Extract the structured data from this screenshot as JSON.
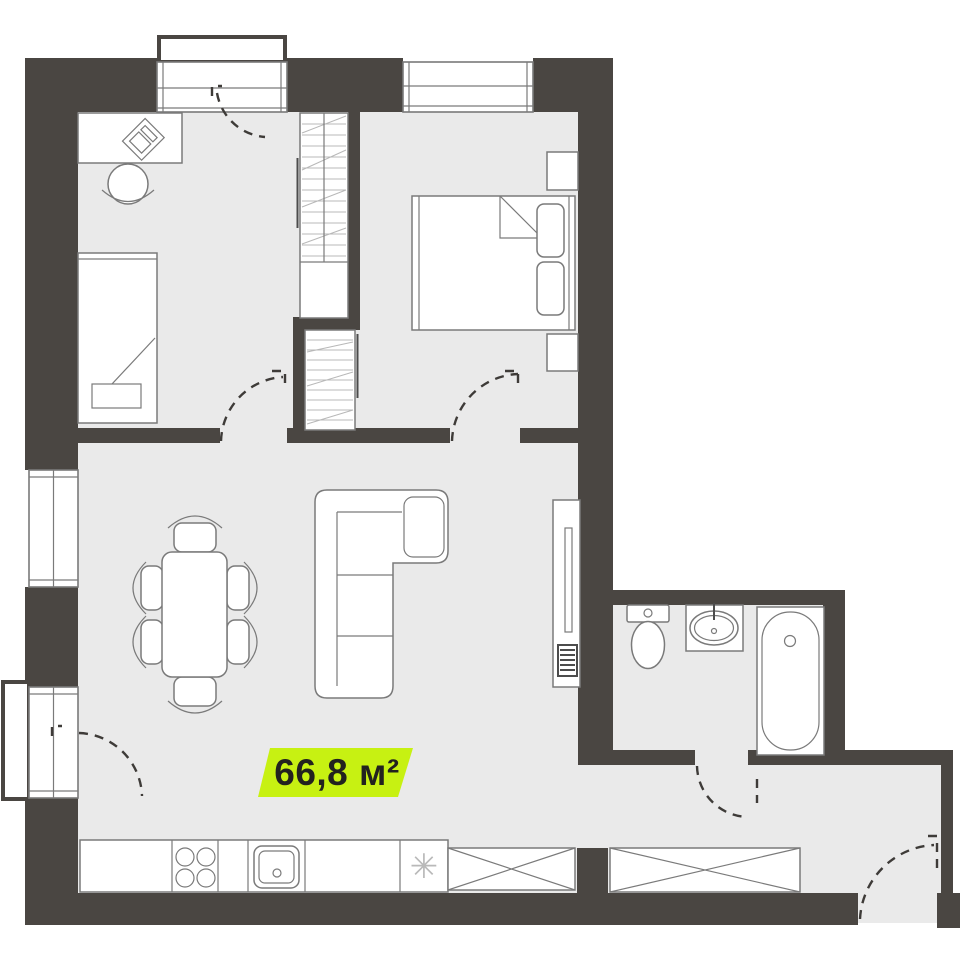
{
  "colors": {
    "wall": "#4a4642",
    "floor": "#eaeaea",
    "outline": "#7a7a7a",
    "outline_dark": "#4c4c4c",
    "hatch": "#b8b8b8",
    "arc": "#3e3b38",
    "accent": "#c7f112",
    "label_text": "#22221f",
    "marker": "#b9b9b9"
  },
  "area_label": {
    "text": "66,8 м²"
  },
  "symbols": {
    "appliance_marker": "✳"
  }
}
